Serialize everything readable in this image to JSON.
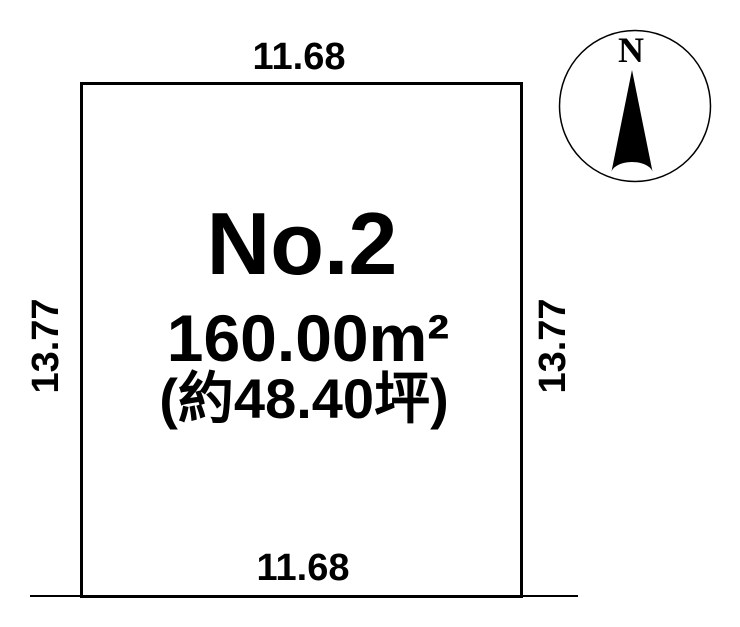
{
  "page": {
    "background": "#ffffff",
    "line_color": "#000000"
  },
  "plot": {
    "label": "No.2",
    "area_m2": "160.00m²",
    "area_tsubo": "(約48.40坪)",
    "dimensions": {
      "top": "11.68",
      "bottom": "11.68",
      "left": "13.77",
      "right": "13.77"
    }
  },
  "compass": {
    "north_label": "N"
  }
}
